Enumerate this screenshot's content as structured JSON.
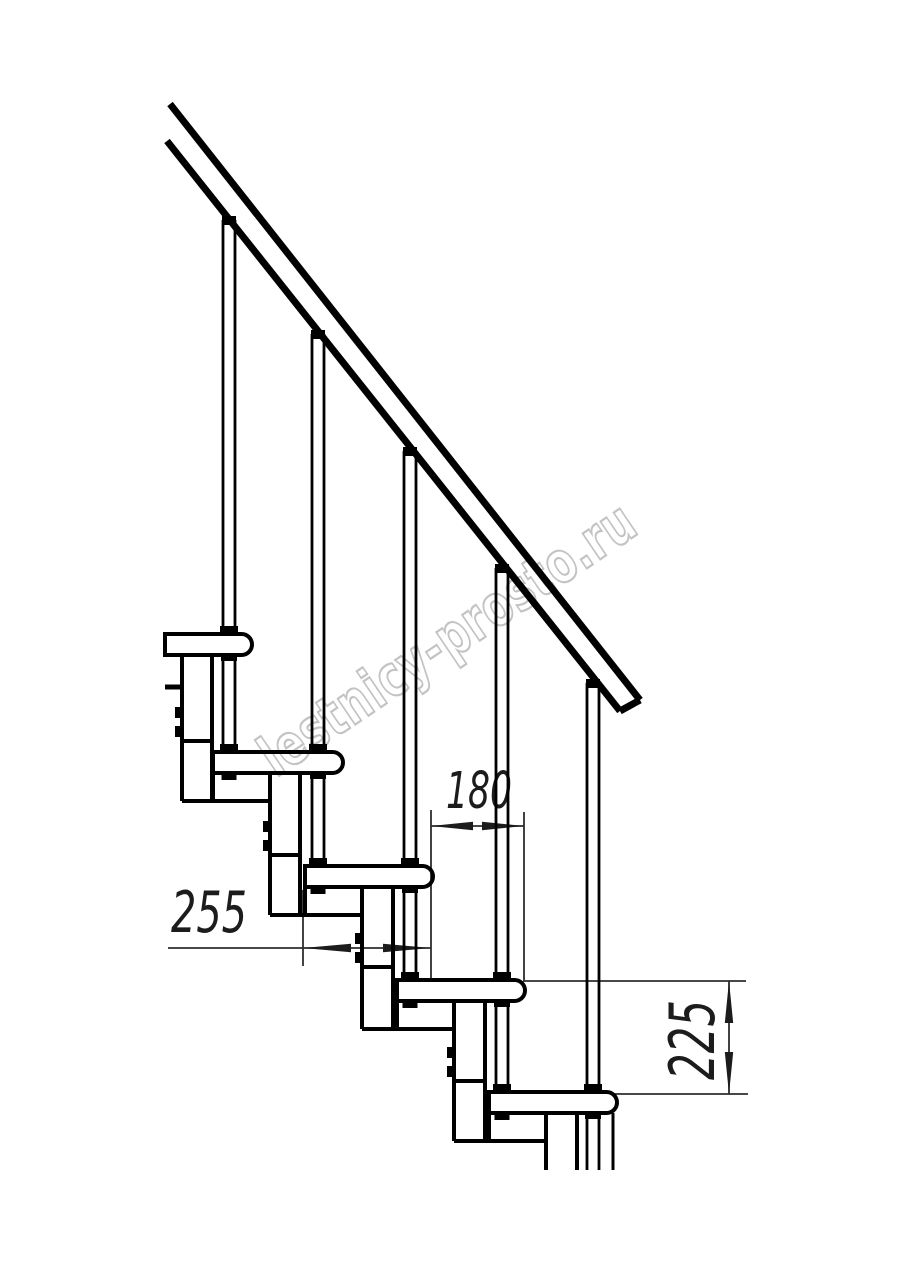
{
  "drawing": {
    "title": "modular-staircase-side-view",
    "colors": {
      "background": "#ffffff",
      "line": "#000000",
      "dimension_line": "#2e2e2e",
      "watermark": "#c3c3c3"
    },
    "dimensions": {
      "tread_depth": "255",
      "step_run": "180",
      "step_rise": "225"
    },
    "watermark": {
      "text": "lestnicy-prosto.ru"
    },
    "counts": {
      "treads_visible": "5",
      "balusters_visible": "5"
    }
  }
}
